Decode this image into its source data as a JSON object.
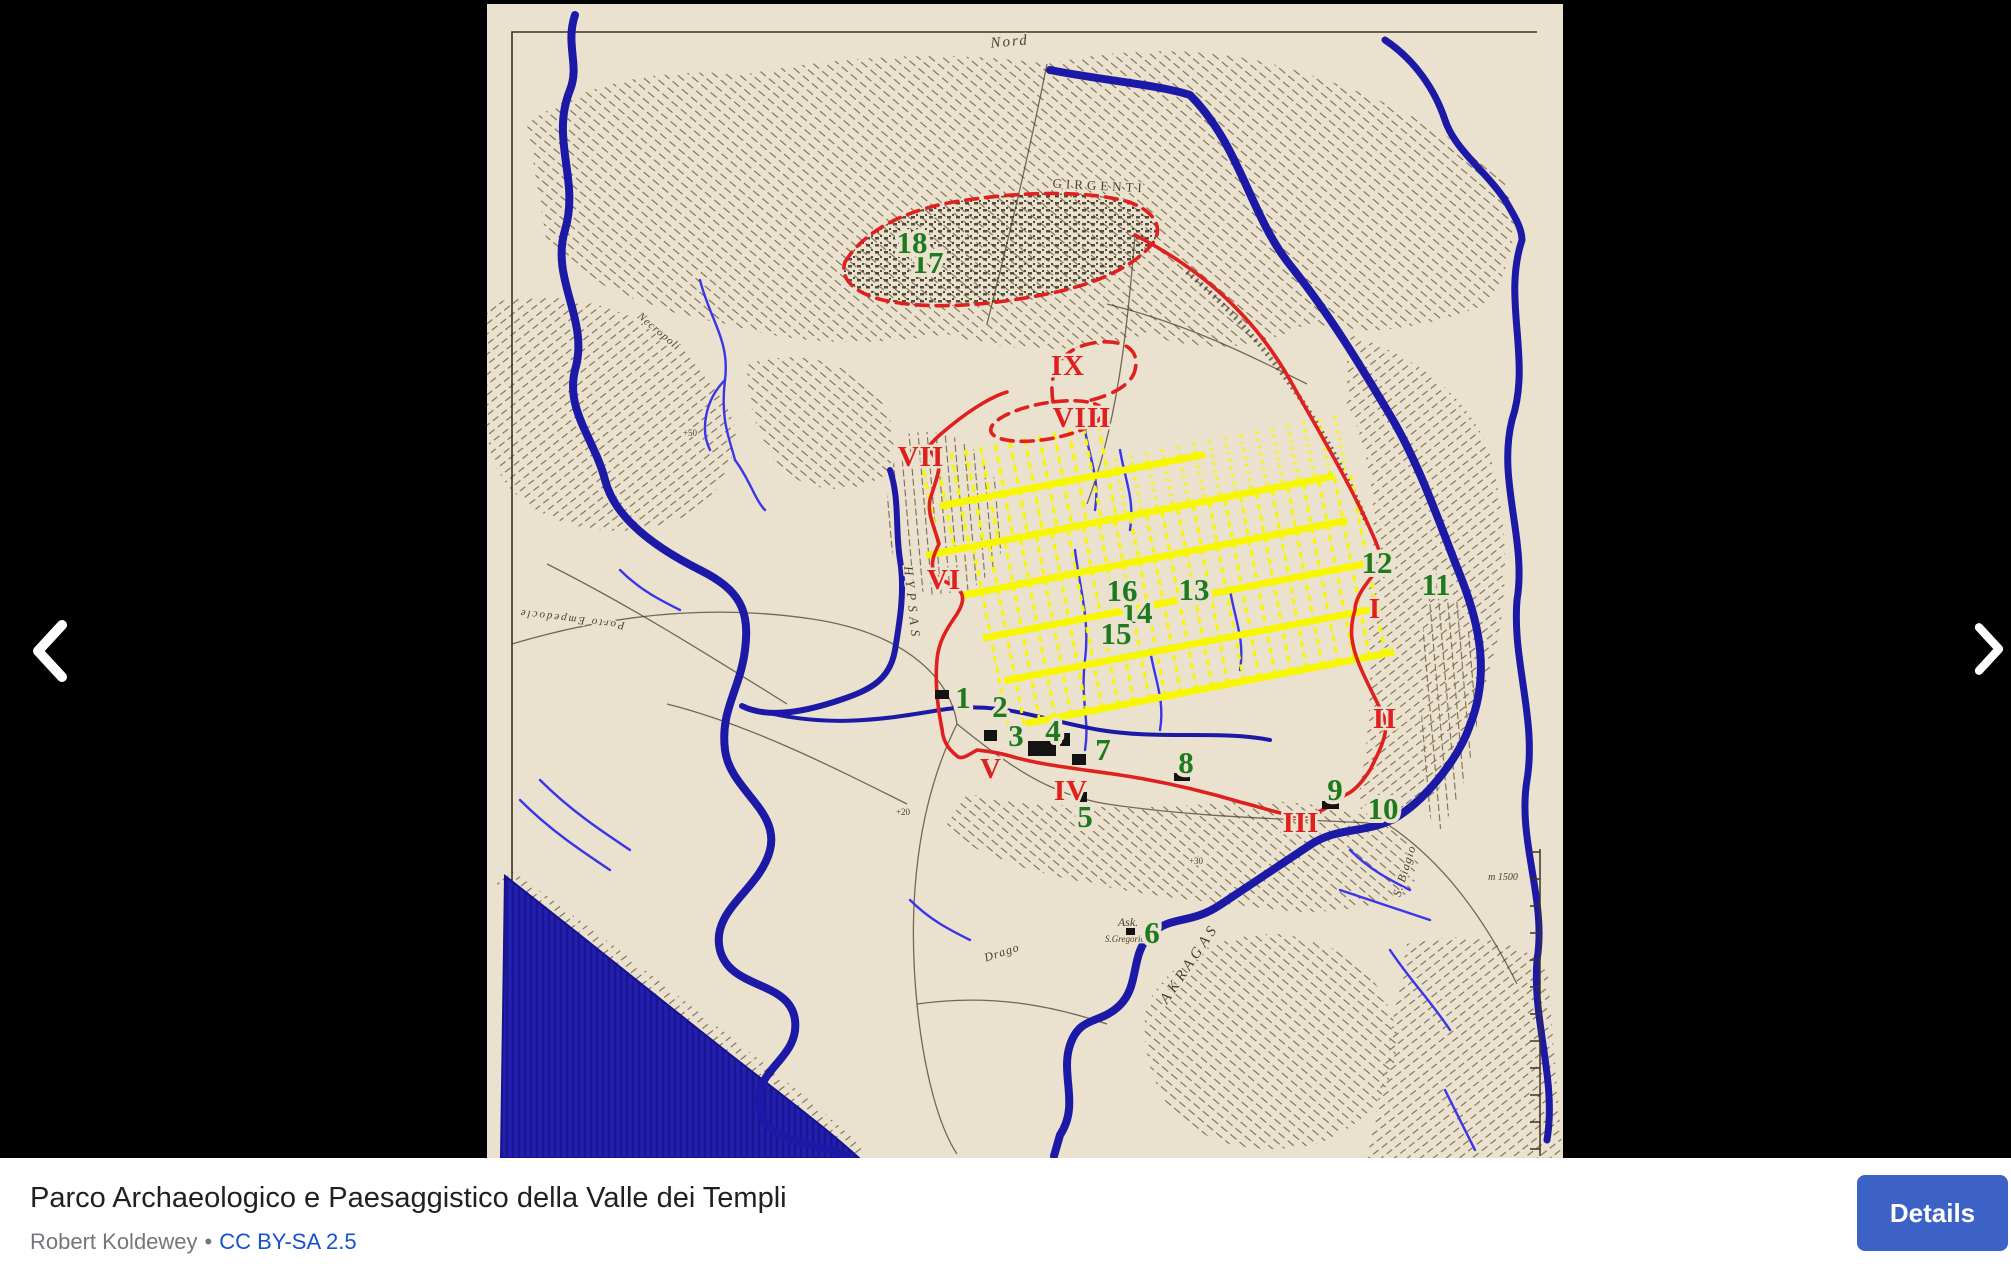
{
  "viewer": {
    "title": "Parco Archaeologico e Paesaggistico della Valle dei Templi",
    "author": "Robert Koldewey",
    "separator": "•",
    "license": "CC BY-SA 2.5",
    "details_label": "Details",
    "colors": {
      "background": "#000000",
      "bar_bg": "#ffffff",
      "title_text": "#1f2023",
      "attribution_text": "#73777b",
      "link_text": "#1652cc",
      "details_bg": "#3c62c8",
      "details_text": "#ffffff",
      "arrow": "#ffffff"
    }
  },
  "map": {
    "colors": {
      "paper": "#eae1cf",
      "terrain": "#6b5c3a",
      "city_ink": "#3a3322",
      "sea": "#201ca8",
      "river": "#1c19a6",
      "stream": "#3a36e8",
      "wall_red": "#e01f1f",
      "grid_yellow": "#f7f700",
      "number_green": "#1e7a1e",
      "building_black": "#131313",
      "label_ink": "#4a3f28"
    },
    "green_numbers": [
      {
        "n": "1",
        "x": 476,
        "y": 704
      },
      {
        "n": "2",
        "x": 513,
        "y": 713
      },
      {
        "n": "3",
        "x": 529,
        "y": 742
      },
      {
        "n": "4",
        "x": 566,
        "y": 737
      },
      {
        "n": "5",
        "x": 598,
        "y": 823
      },
      {
        "n": "6",
        "x": 665,
        "y": 939
      },
      {
        "n": "7",
        "x": 616,
        "y": 756
      },
      {
        "n": "8",
        "x": 699,
        "y": 769
      },
      {
        "n": "9",
        "x": 848,
        "y": 796
      },
      {
        "n": "10",
        "x": 896,
        "y": 815
      },
      {
        "n": "11",
        "x": 949,
        "y": 591
      },
      {
        "n": "12",
        "x": 890,
        "y": 569
      },
      {
        "n": "13",
        "x": 707,
        "y": 596
      },
      {
        "n": "14",
        "x": 650,
        "y": 619
      },
      {
        "n": "15",
        "x": 629,
        "y": 640
      },
      {
        "n": "16",
        "x": 635,
        "y": 597
      },
      {
        "n": "17",
        "x": 441,
        "y": 269
      },
      {
        "n": "18",
        "x": 425,
        "y": 249
      }
    ],
    "roman_numerals": [
      {
        "n": "I",
        "x": 888,
        "y": 614
      },
      {
        "n": "II",
        "x": 898,
        "y": 724
      },
      {
        "n": "III",
        "x": 814,
        "y": 828
      },
      {
        "n": "IV",
        "x": 584,
        "y": 796
      },
      {
        "n": "V",
        "x": 504,
        "y": 774
      },
      {
        "n": "VI",
        "x": 457,
        "y": 585
      },
      {
        "n": "VII",
        "x": 434,
        "y": 462
      },
      {
        "n": "VIII",
        "x": 595,
        "y": 423
      },
      {
        "n": "IX",
        "x": 581,
        "y": 371
      }
    ],
    "place_labels": [
      {
        "text": "Nord",
        "x": 523,
        "y": 42,
        "size": 15,
        "rotate": -5,
        "italic": true,
        "spacing": 2
      },
      {
        "text": "GIRGENTI",
        "x": 612,
        "y": 186,
        "size": 13,
        "rotate": 3,
        "italic": false,
        "spacing": 4
      },
      {
        "text": "HYPSAS",
        "x": 421,
        "y": 600,
        "size": 13,
        "rotate": 84,
        "italic": true,
        "spacing": 5
      },
      {
        "text": "AKRAGAS",
        "x": 706,
        "y": 962,
        "size": 15,
        "rotate": -56,
        "italic": true,
        "spacing": 4
      },
      {
        "text": "Drago",
        "x": 516,
        "y": 952,
        "size": 12,
        "rotate": -18,
        "italic": true,
        "spacing": 1
      },
      {
        "text": "Ask.",
        "x": 641,
        "y": 922,
        "size": 12,
        "rotate": 0,
        "italic": true,
        "spacing": 0
      },
      {
        "text": "S.Gregorio",
        "x": 638,
        "y": 938,
        "size": 9,
        "rotate": 0,
        "italic": true,
        "spacing": 0
      },
      {
        "text": "S. Biagio",
        "x": 921,
        "y": 868,
        "size": 12,
        "rotate": -73,
        "italic": true,
        "spacing": 1
      },
      {
        "text": "Porto Empedocle",
        "x": 85,
        "y": 612,
        "size": 11,
        "rotate": 187,
        "italic": true,
        "spacing": 2
      },
      {
        "text": "Necropoli",
        "x": 170,
        "y": 330,
        "size": 11,
        "rotate": 40,
        "italic": true,
        "spacing": 1
      },
      {
        "text": "m 1500",
        "x": 1016,
        "y": 876,
        "size": 10,
        "rotate": 0,
        "italic": true,
        "spacing": 0
      },
      {
        "text": "+50",
        "x": 203,
        "y": 432,
        "size": 9,
        "rotate": 0,
        "italic": false,
        "spacing": 0
      },
      {
        "text": "+20",
        "x": 416,
        "y": 811,
        "size": 9,
        "rotate": 0,
        "italic": false,
        "spacing": 0
      },
      {
        "text": "+30",
        "x": 709,
        "y": 860,
        "size": 9,
        "rotate": 0,
        "italic": false,
        "spacing": 0
      }
    ]
  }
}
